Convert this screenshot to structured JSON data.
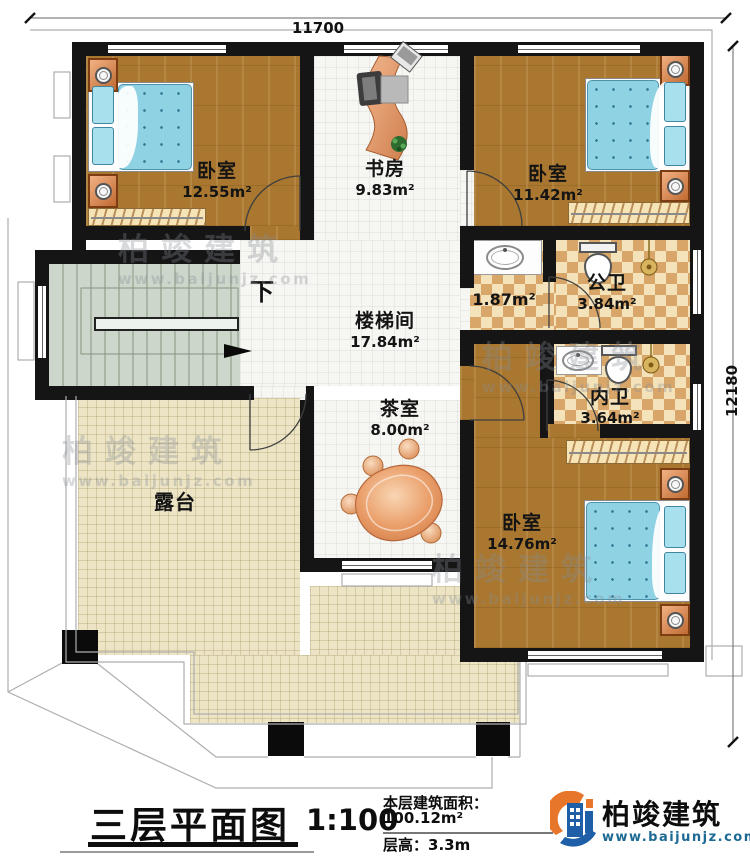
{
  "dimensions": {
    "top": "11700",
    "right": "12180"
  },
  "rooms": {
    "bedroom_tl": {
      "name": "卧室",
      "area": "12.55m²"
    },
    "study": {
      "name": "书房",
      "area": "9.83m²"
    },
    "bedroom_tr": {
      "name": "卧室",
      "area": "11.42m²"
    },
    "vanity": {
      "area": "1.87m²"
    },
    "public_bath": {
      "name": "公卫",
      "area": "3.84m²"
    },
    "private_bath": {
      "name": "内卫",
      "area": "3.64m²"
    },
    "stair_hall": {
      "name": "楼梯间",
      "area": "17.84m²"
    },
    "tea_room": {
      "name": "茶室",
      "area": "8.00m²"
    },
    "bedroom_br": {
      "name": "卧室",
      "area": "14.76m²"
    },
    "terrace": {
      "name": "露台"
    }
  },
  "stairs": {
    "direction_label": "下"
  },
  "title_block": {
    "title": "三层平面图",
    "scale": "1:100",
    "floor_area_label": "本层建筑面积：",
    "floor_area_value": "100.12m²",
    "floor_height_label": "层高：",
    "floor_height_value": "3.3m"
  },
  "brand": {
    "name": "柏竣建筑",
    "website": "www.baijunjz.com"
  },
  "watermark": {
    "name": "柏竣建筑",
    "website": "www.baijunjz.com"
  },
  "colors": {
    "wall": "#151515",
    "wood_floor": "#a9772f",
    "tile_floor": "#f6f6f2",
    "terrace_floor": "#ece4c5",
    "checker_dark": "#d8a668",
    "checker_light": "#f3e2ba",
    "stair": "#ccd6cb",
    "bed_blue": "#8fd2e4",
    "furniture_orange": "#e0904f",
    "brand_blue": "#1f5fa8",
    "brand_orange": "#e8762a",
    "url_teal": "#1d6a94"
  }
}
